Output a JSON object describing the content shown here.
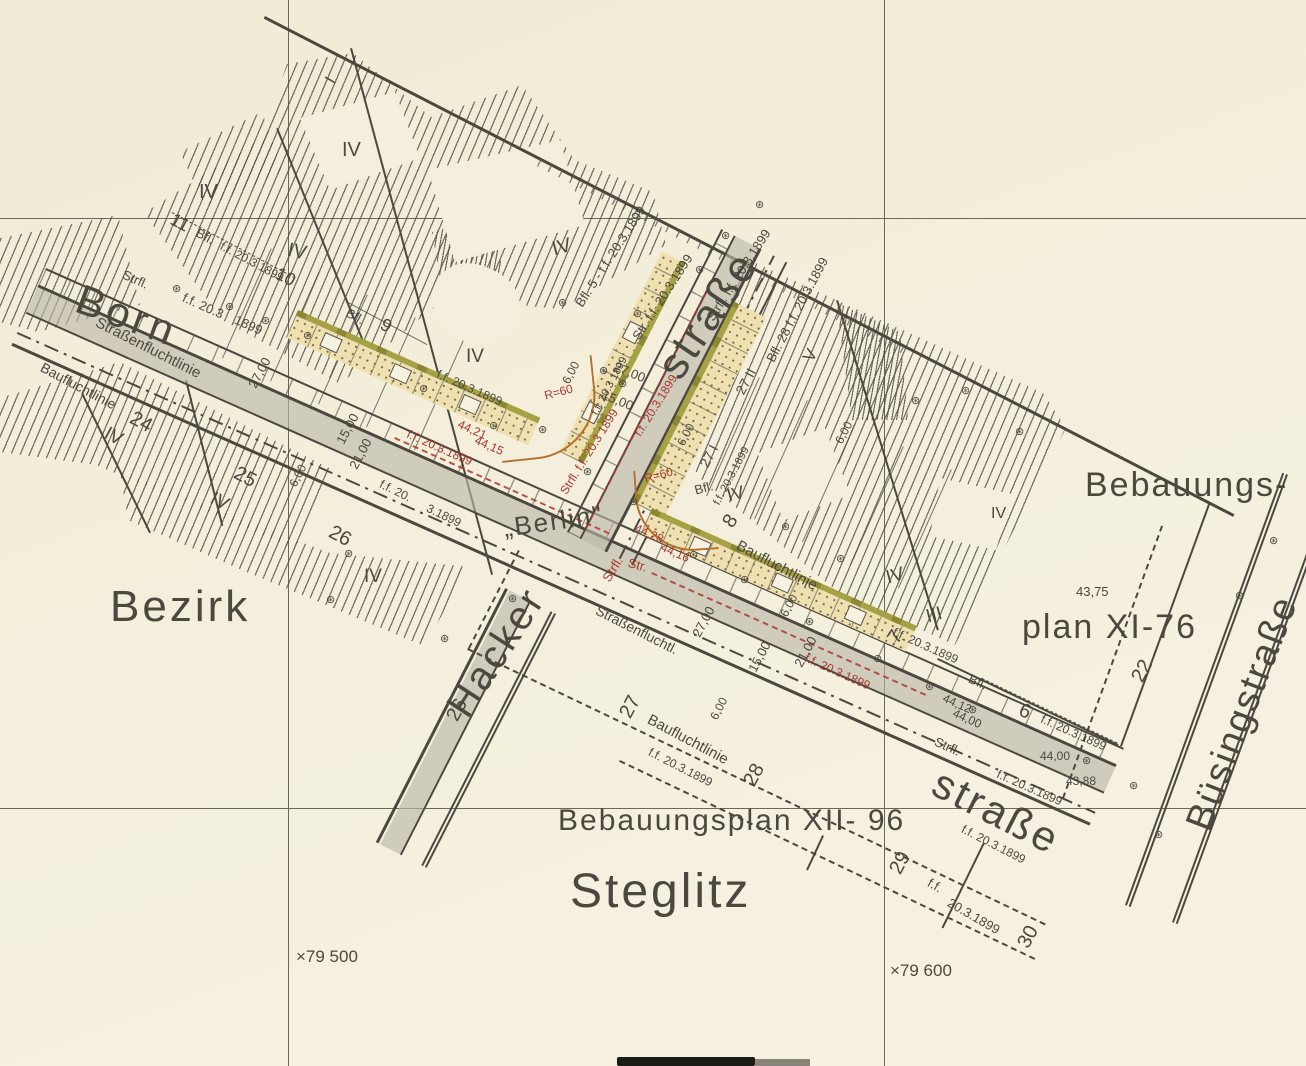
{
  "title": "Bebauungsplan Berlin-Steglitz, Fluchtlinien festgesetzt f.f. 20.3.1899",
  "palette": {
    "paper": "#f4efdc",
    "ink": "#4b4840",
    "red": "#a8392f",
    "grey_band": "#c3bfb1",
    "olive": "#a6a144",
    "buff": "#eee0b0",
    "dot_brown": "#80683c",
    "curve_tan": "#b5702f",
    "hatch": "#55524a"
  },
  "streets": [
    "Bornstraße",
    "Hackerstraße",
    "Büsingstraße"
  ],
  "district": "Bezirk Steglitz",
  "plans": [
    "Bebauungsplan XI-76",
    "Bebauungsplan XII- 96"
  ],
  "grid_coordinates": [
    "79 500",
    "79 600"
  ],
  "symbols": {
    "boundary_stone": {
      "icon": "boundary-stone-icon",
      "glyph": "⊛"
    }
  },
  "stones": [
    [
      177,
      289
    ],
    [
      230,
      307
    ],
    [
      266,
      321
    ],
    [
      308,
      336
    ],
    [
      424,
      389
    ],
    [
      494,
      426
    ],
    [
      563,
      303
    ],
    [
      638,
      314
    ],
    [
      700,
      270
    ],
    [
      604,
      371
    ],
    [
      623,
      384
    ],
    [
      543,
      430
    ],
    [
      588,
      472
    ],
    [
      634,
      502
    ],
    [
      694,
      555
    ],
    [
      745,
      580
    ],
    [
      810,
      622
    ],
    [
      878,
      659
    ],
    [
      930,
      687
    ],
    [
      973,
      710
    ],
    [
      349,
      554
    ],
    [
      331,
      600
    ],
    [
      445,
      639
    ],
    [
      513,
      599
    ],
    [
      786,
      527
    ],
    [
      841,
      559
    ],
    [
      1087,
      761
    ],
    [
      1134,
      786
    ],
    [
      1240,
      596
    ],
    [
      1274,
      541
    ],
    [
      1159,
      835
    ],
    [
      916,
      401
    ],
    [
      966,
      391
    ],
    [
      1020,
      432
    ],
    [
      760,
      205
    ],
    [
      726,
      236
    ]
  ],
  "labels": [
    {
      "n": "street-name-born",
      "t": "Born",
      "x": 85,
      "y": 278,
      "r": 20,
      "s": 42,
      "ls": 4
    },
    {
      "n": "street-name-strasse-north",
      "t": "straße",
      "x": 650,
      "y": 362,
      "r": -56,
      "s": 44,
      "ls": 3
    },
    {
      "n": "street-name-hacker",
      "t": "Hacker",
      "x": 440,
      "y": 702,
      "r": -57,
      "s": 40,
      "ls": 3
    },
    {
      "n": "street-name-strasse-south",
      "t": "straße",
      "x": 945,
      "y": 762,
      "r": 27,
      "s": 42,
      "ls": 3
    },
    {
      "n": "street-name-buesingstrasse",
      "t": "Büsingstraße",
      "x": 1180,
      "y": 822,
      "r": -69,
      "s": 38,
      "ls": 2
    },
    {
      "n": "district-label-bezirk",
      "t": "Bezirk",
      "x": 110,
      "y": 585,
      "r": 0,
      "s": 44,
      "ls": 3
    },
    {
      "n": "district-label-steglitz",
      "t": "Steglitz",
      "x": 570,
      "y": 868,
      "r": 0,
      "s": 48,
      "ls": 3
    },
    {
      "n": "plan-label-bebauungs",
      "t": "Bebauungs-",
      "x": 1085,
      "y": 468,
      "r": 0,
      "s": 34,
      "ls": 2
    },
    {
      "n": "plan-label-xi76",
      "t": "plan XI-76",
      "x": 1022,
      "y": 610,
      "r": 0,
      "s": 34,
      "ls": 2
    },
    {
      "n": "plan-label-xii96",
      "t": "Bebauungsplan XII- 96",
      "x": 558,
      "y": 806,
      "r": 0,
      "s": 30,
      "ls": 2
    },
    {
      "n": "city-label-berlin",
      "t": "„Berlin\"",
      "x": 502,
      "y": 515,
      "r": -8,
      "s": 26,
      "ls": 2
    },
    {
      "n": "fluchtlinie-label",
      "t": "Strfl.",
      "x": 126,
      "y": 268,
      "r": 24,
      "s": 13
    },
    {
      "n": "date-label",
      "t": "f.f. 20.3",
      "x": 186,
      "y": 291,
      "r": 24,
      "s": 13
    },
    {
      "n": "date-label",
      "t": "1899",
      "x": 238,
      "y": 313,
      "r": 24,
      "s": 13
    },
    {
      "n": "fluchtlinie-label",
      "t": "Straßenfluchtlinie",
      "x": 100,
      "y": 315,
      "r": 27,
      "s": 15
    },
    {
      "n": "fluchtlinie-label",
      "t": "Baufluchtlinie",
      "x": 45,
      "y": 360,
      "r": 28,
      "s": 14
    },
    {
      "n": "parcel-number",
      "t": "24",
      "x": 136,
      "y": 408,
      "r": 28,
      "s": 20
    },
    {
      "n": "parcel-number",
      "t": "25",
      "x": 240,
      "y": 463,
      "r": 28,
      "s": 20
    },
    {
      "n": "parcel-number",
      "t": "26",
      "x": 335,
      "y": 522,
      "r": 28,
      "s": 20
    },
    {
      "n": "parcel-number",
      "t": "11",
      "x": 176,
      "y": 210,
      "r": 28,
      "s": 18
    },
    {
      "n": "fluchtlinie-label",
      "t": "Bfl.",
      "x": 200,
      "y": 226,
      "r": 28,
      "s": 13
    },
    {
      "n": "date-label",
      "t": "f.f. 20.3.1899",
      "x": 224,
      "y": 240,
      "r": 28,
      "s": 12
    },
    {
      "n": "parcel-number",
      "t": "10",
      "x": 281,
      "y": 264,
      "r": 28,
      "s": 18
    },
    {
      "n": "fluchtlinie-label",
      "t": "Bfl.",
      "x": 350,
      "y": 306,
      "r": 28,
      "s": 13
    },
    {
      "n": "parcel-number",
      "t": "9",
      "x": 386,
      "y": 315,
      "r": 28,
      "s": 18
    },
    {
      "n": "date-label",
      "t": "f.f. 20.3.1899",
      "x": 440,
      "y": 368,
      "r": 24,
      "s": 12
    },
    {
      "n": "date-label",
      "t": "f.f. 20.",
      "x": 383,
      "y": 478,
      "r": 26,
      "s": 12
    },
    {
      "n": "date-label",
      "t": "3.1899",
      "x": 430,
      "y": 502,
      "r": 26,
      "s": 12
    },
    {
      "n": "dimension-label",
      "t": "27,00",
      "x": 246,
      "y": 384,
      "r": -62,
      "s": 13
    },
    {
      "n": "dimension-label",
      "t": "15,00",
      "x": 334,
      "y": 440,
      "r": -62,
      "s": 13
    },
    {
      "n": "dimension-label",
      "t": "21,00",
      "x": 347,
      "y": 465,
      "r": -62,
      "s": 13
    },
    {
      "n": "dimension-label",
      "t": "6,00",
      "x": 287,
      "y": 483,
      "r": -62,
      "s": 12
    },
    {
      "n": "fluchtlinie-label",
      "t": "Bfl. 5 - f.f. 20.3.1899",
      "x": 573,
      "y": 302,
      "r": -57,
      "s": 13
    },
    {
      "n": "fluchtlinie-label",
      "t": "Str. f.f. 20.3.1899",
      "x": 630,
      "y": 335,
      "r": -57,
      "s": 13
    },
    {
      "n": "fluchtlinie-label",
      "t": "Strfl. f.f. 20.3.1899",
      "x": 704,
      "y": 316,
      "r": -57,
      "s": 13
    },
    {
      "n": "parcel-number",
      "t": "27 II",
      "x": 733,
      "y": 390,
      "r": -62,
      "s": 14
    },
    {
      "n": "fluchtlinie-label",
      "t": "Bfl. 28 f.f. 20.3.1899",
      "x": 764,
      "y": 358,
      "r": -62,
      "s": 13
    },
    {
      "n": "storey-numeral",
      "t": "V",
      "x": 800,
      "y": 356,
      "r": -60,
      "s": 17
    },
    {
      "n": "storey-numeral",
      "t": "I",
      "x": 322,
      "y": 78,
      "r": -60,
      "s": 17
    },
    {
      "n": "dimension-label",
      "t": "27,00",
      "x": 617,
      "y": 360,
      "r": 22,
      "s": 13
    },
    {
      "n": "dimension-label",
      "t": "15,00",
      "x": 605,
      "y": 388,
      "r": 22,
      "s": 13
    },
    {
      "n": "dimension-label",
      "t": "6,00",
      "x": 560,
      "y": 380,
      "r": -62,
      "s": 12
    },
    {
      "n": "dimension-label",
      "t": "6,00",
      "x": 675,
      "y": 442,
      "r": -62,
      "s": 12
    },
    {
      "n": "parcel-number",
      "t": "27 I",
      "x": 697,
      "y": 463,
      "r": -62,
      "s": 14
    },
    {
      "n": "date-label",
      "t": "f.f. 20.3.1899",
      "x": 712,
      "y": 502,
      "r": -62,
      "s": 11
    },
    {
      "n": "parcel-number",
      "t": "8",
      "x": 719,
      "y": 520,
      "r": -56,
      "s": 20
    },
    {
      "n": "fluchtlinie-label",
      "t": "Baufluchtlinie",
      "x": 741,
      "y": 538,
      "r": 28,
      "s": 15
    },
    {
      "n": "fluchtlinie-label",
      "t": "Bfl.",
      "x": 693,
      "y": 484,
      "r": -15,
      "s": 13
    },
    {
      "n": "storey-numeral",
      "t": "IV",
      "x": 725,
      "y": 487,
      "r": -15,
      "s": 18
    },
    {
      "n": "parcel-number",
      "t": "7",
      "x": 884,
      "y": 636,
      "r": -56,
      "s": 20
    },
    {
      "n": "date-label",
      "t": "f.f. 20.3.1899",
      "x": 896,
      "y": 626,
      "r": 24,
      "s": 12
    },
    {
      "n": "dimension-label",
      "t": "27,00",
      "x": 690,
      "y": 633,
      "r": -62,
      "s": 13
    },
    {
      "n": "dimension-label",
      "t": "15,00",
      "x": 746,
      "y": 668,
      "r": -62,
      "s": 13
    },
    {
      "n": "dimension-label",
      "t": "21,00",
      "x": 792,
      "y": 663,
      "r": -62,
      "s": 13
    },
    {
      "n": "dimension-label",
      "t": "6,00",
      "x": 778,
      "y": 613,
      "r": -62,
      "s": 12
    },
    {
      "n": "dimension-label",
      "t": "6,00",
      "x": 708,
      "y": 716,
      "r": -62,
      "s": 12
    },
    {
      "n": "dimension-label",
      "t": "6,00",
      "x": 833,
      "y": 440,
      "r": -62,
      "s": 12
    },
    {
      "n": "date-label",
      "t": "f.f. 20.3.1899",
      "x": 808,
      "y": 652,
      "r": 24,
      "s": 12,
      "c": "r"
    },
    {
      "n": "date-label",
      "t": "f.f. 20.3.1899",
      "x": 410,
      "y": 428,
      "r": 24,
      "s": 12,
      "c": "r"
    },
    {
      "n": "fluchtlinie-label",
      "t": "Strfl.",
      "x": 600,
      "y": 577,
      "r": -58,
      "s": 13,
      "c": "r"
    },
    {
      "n": "date-label",
      "t": "f.f. 20.3.1899",
      "x": 632,
      "y": 432,
      "r": -58,
      "s": 12,
      "c": "r"
    },
    {
      "n": "fluchtlinie-label",
      "t": "Strfl. f.f. 20.3 1899",
      "x": 558,
      "y": 490,
      "r": -58,
      "s": 12,
      "c": "r"
    },
    {
      "n": "radius-label",
      "t": "R=60",
      "x": 543,
      "y": 390,
      "r": -15,
      "s": 12,
      "c": "r"
    },
    {
      "n": "radius-label",
      "t": "R=60",
      "x": 643,
      "y": 473,
      "r": -15,
      "s": 12,
      "c": "r"
    },
    {
      "n": "elevation-label",
      "t": "44,21",
      "x": 461,
      "y": 418,
      "r": 24,
      "s": 12,
      "c": "r"
    },
    {
      "n": "elevation-label",
      "t": "44,15",
      "x": 478,
      "y": 434,
      "r": 24,
      "s": 12,
      "c": "r"
    },
    {
      "n": "elevation-label",
      "t": "44,28",
      "x": 638,
      "y": 522,
      "r": 24,
      "s": 12,
      "c": "r"
    },
    {
      "n": "elevation-label",
      "t": "44,16",
      "x": 664,
      "y": 541,
      "r": 24,
      "s": 12,
      "c": "r"
    },
    {
      "n": "fluchtlinie-label",
      "t": "Str.",
      "x": 630,
      "y": 556,
      "r": 15,
      "s": 13,
      "c": "r"
    },
    {
      "n": "date-label",
      "t": "f.f. 20.3 1899",
      "x": 590,
      "y": 412,
      "r": -62,
      "s": 11
    },
    {
      "n": "fluchtlinie-label",
      "t": "Strfl.",
      "x": 938,
      "y": 735,
      "r": 24,
      "s": 13
    },
    {
      "n": "date-label",
      "t": "f.f. 20.3.1899",
      "x": 1000,
      "y": 768,
      "r": 24,
      "s": 12
    },
    {
      "n": "elevation-label",
      "t": "44,12",
      "x": 946,
      "y": 692,
      "r": 24,
      "s": 12
    },
    {
      "n": "elevation-label",
      "t": "44,00",
      "x": 956,
      "y": 707,
      "r": 24,
      "s": 12
    },
    {
      "n": "fluchtlinie-label",
      "t": "Bfl.",
      "x": 972,
      "y": 672,
      "r": 24,
      "s": 13
    },
    {
      "n": "parcel-number",
      "t": "6",
      "x": 1024,
      "y": 700,
      "r": 24,
      "s": 20
    },
    {
      "n": "date-label",
      "t": "f.f. 20.3.1899",
      "x": 1044,
      "y": 713,
      "r": 24,
      "s": 12
    },
    {
      "n": "elevation-label",
      "t": "44,00",
      "x": 1040,
      "y": 750,
      "r": 0,
      "s": 12
    },
    {
      "n": "elevation-label",
      "t": "43,88",
      "x": 1066,
      "y": 775,
      "r": 0,
      "s": 12
    },
    {
      "n": "elevation-label",
      "t": "43,75",
      "x": 1076,
      "y": 585,
      "r": 0,
      "s": 13
    },
    {
      "n": "parcel-number",
      "t": "22",
      "x": 1128,
      "y": 676,
      "r": -62,
      "s": 20
    },
    {
      "n": "fluchtlinie-label",
      "t": "Straßenfluchtl.",
      "x": 600,
      "y": 603,
      "r": 27,
      "s": 14
    },
    {
      "n": "parcel-number",
      "t": "26",
      "x": 443,
      "y": 715,
      "r": -62,
      "s": 20
    },
    {
      "n": "parcel-number",
      "t": "27",
      "x": 616,
      "y": 712,
      "r": -62,
      "s": 20
    },
    {
      "n": "fluchtlinie-label",
      "t": "Baufluchtlinie",
      "x": 652,
      "y": 712,
      "r": 28,
      "s": 15
    },
    {
      "n": "parcel-number",
      "t": "28",
      "x": 740,
      "y": 780,
      "r": -62,
      "s": 20
    },
    {
      "n": "parcel-number",
      "t": "29",
      "x": 886,
      "y": 868,
      "r": -62,
      "s": 20
    },
    {
      "n": "parcel-number",
      "t": "30",
      "x": 1014,
      "y": 942,
      "r": -62,
      "s": 20
    },
    {
      "n": "date-label",
      "t": "f.f. 20.3.1899",
      "x": 652,
      "y": 746,
      "r": 27,
      "s": 12
    },
    {
      "n": "date-label",
      "t": "f.f. 20.3.1899",
      "x": 965,
      "y": 823,
      "r": 27,
      "s": 12
    },
    {
      "n": "date-label",
      "t": "f.f.",
      "x": 932,
      "y": 876,
      "r": 30,
      "s": 13
    },
    {
      "n": "date-label",
      "t": "20.3.1899",
      "x": 952,
      "y": 896,
      "r": 30,
      "s": 13
    },
    {
      "n": "grid-coordinate",
      "t": "×79 500",
      "x": 296,
      "y": 948,
      "r": 0,
      "s": 17
    },
    {
      "n": "grid-coordinate",
      "t": "×79 600",
      "x": 890,
      "y": 962,
      "r": 0,
      "s": 17
    },
    {
      "n": "storey-numeral",
      "t": "IV",
      "x": 110,
      "y": 424,
      "r": 28,
      "s": 19
    },
    {
      "n": "storey-numeral",
      "t": "IV",
      "x": 199,
      "y": 182,
      "r": 0,
      "s": 20
    },
    {
      "n": "storey-numeral",
      "t": "IV",
      "x": 342,
      "y": 140,
      "r": 0,
      "s": 20
    },
    {
      "n": "storey-numeral",
      "t": "IV",
      "x": 290,
      "y": 240,
      "r": 12,
      "s": 20
    },
    {
      "n": "storey-numeral",
      "t": "IV",
      "x": 550,
      "y": 240,
      "r": -15,
      "s": 20
    },
    {
      "n": "storey-numeral",
      "t": "IV",
      "x": 466,
      "y": 347,
      "r": 0,
      "s": 19
    },
    {
      "n": "storey-numeral",
      "t": "IV",
      "x": 216,
      "y": 489,
      "r": 28,
      "s": 19
    },
    {
      "n": "storey-numeral",
      "t": "IV",
      "x": 364,
      "y": 567,
      "r": 0,
      "s": 19
    },
    {
      "n": "storey-numeral",
      "t": "IV",
      "x": 884,
      "y": 569,
      "r": -15,
      "s": 19
    },
    {
      "n": "storey-numeral",
      "t": "III",
      "x": 924,
      "y": 608,
      "r": -15,
      "s": 19
    },
    {
      "n": "storey-numeral",
      "t": "IV",
      "x": 991,
      "y": 506,
      "r": 0,
      "s": 16
    }
  ]
}
